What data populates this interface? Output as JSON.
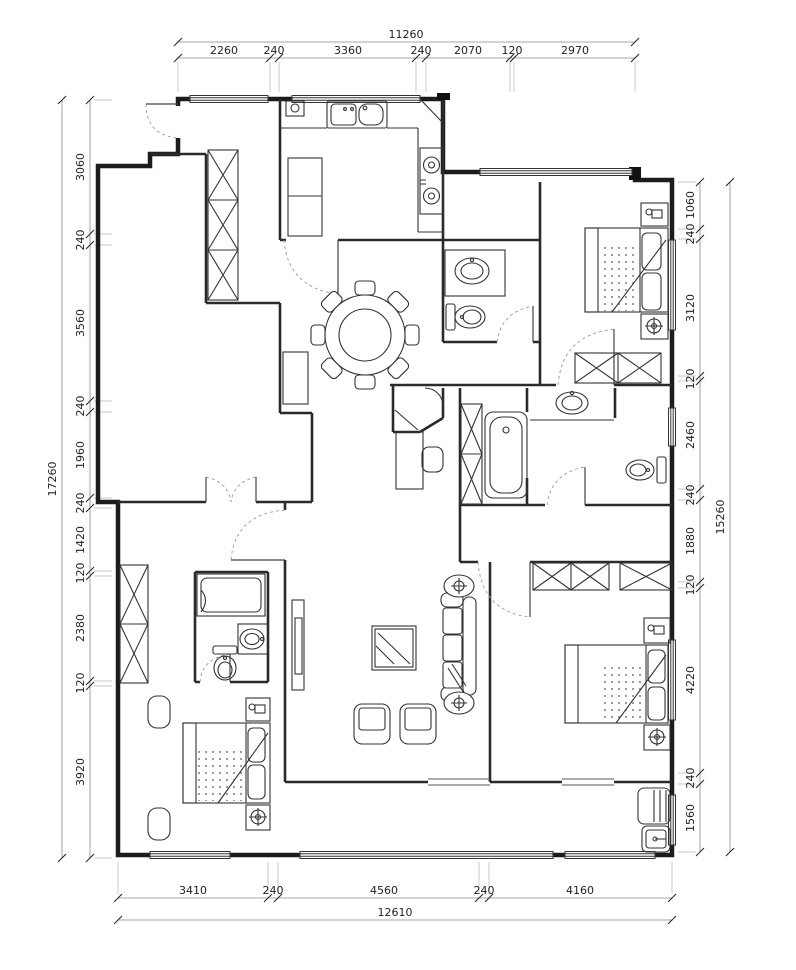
{
  "drawing": {
    "kind": "residential floor plan",
    "units": "mm",
    "line_color": "#222222",
    "background": "#ffffff"
  },
  "dims": {
    "top": {
      "total": "11260",
      "segments": [
        "2260",
        "240",
        "3360",
        "240",
        "2070",
        "120",
        "2970"
      ]
    },
    "bottom": {
      "total": "12610",
      "segments": [
        "3410",
        "240",
        "4560",
        "240",
        "4160"
      ]
    },
    "left": {
      "total": "17260",
      "segments": [
        "3060",
        "240",
        "3560",
        "240",
        "1960",
        "240",
        "1420",
        "120",
        "2380",
        "120",
        "3920"
      ]
    },
    "right": {
      "total": "15260",
      "segments": [
        "1060",
        "240",
        "3120",
        "120",
        "2460",
        "240",
        "1880",
        "120",
        "4220",
        "240",
        "1560"
      ]
    }
  }
}
